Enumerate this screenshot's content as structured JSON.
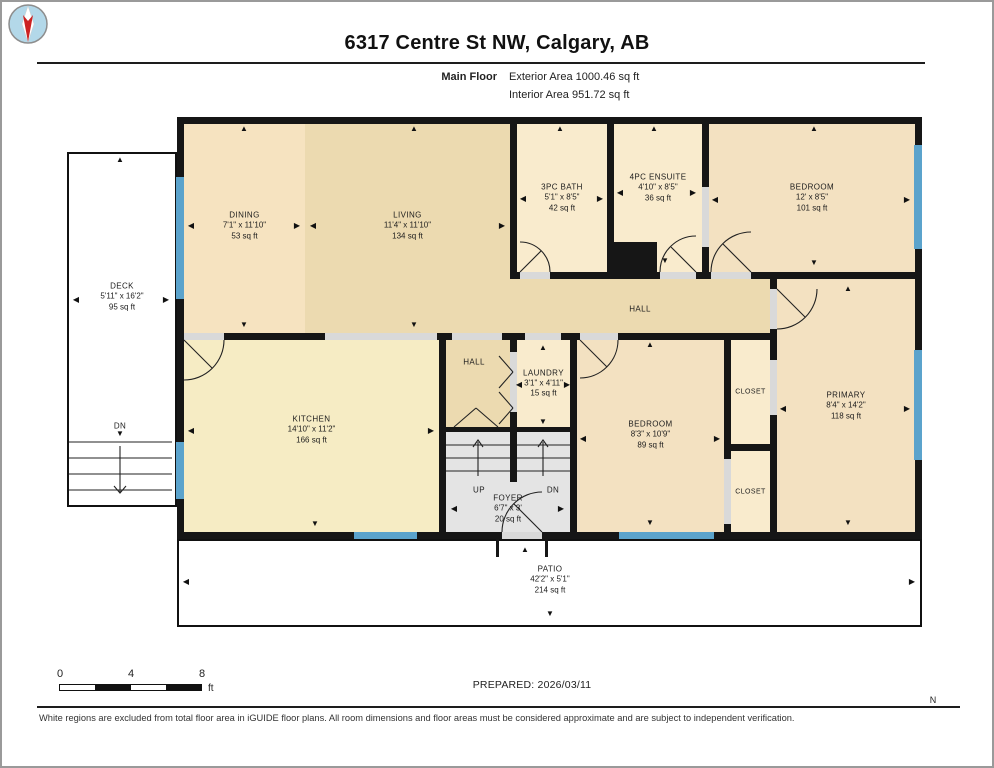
{
  "header": {
    "title": "6317 Centre St NW, Calgary, AB",
    "floor_label": "Main Floor",
    "exterior_area": "Exterior Area 1000.46 sq ft",
    "interior_area": "Interior Area 951.72 sq ft"
  },
  "footer": {
    "scale": {
      "ticks": [
        "0",
        "4",
        "8"
      ],
      "unit": "ft"
    },
    "prepared": "PREPARED: 2026/03/11",
    "compass_label": "N",
    "disclaimer": "White regions are excluded from total floor area in iGUIDE floor plans. All room dimensions and floor areas must be considered approximate and are subject to independent verification."
  },
  "floorplan": {
    "palette": {
      "wall": "#161616",
      "cream": "#f9ebcd",
      "cream2": "#f6e3c0",
      "tan": "#ecdab0",
      "yellow": "#f6ecc4",
      "peach": "#f3e1c1",
      "gray": "#e4e4e4",
      "window": "#5ba3cc",
      "opening": "#d9d9d9",
      "white": "#ffffff"
    },
    "structures": [
      {
        "id": "building-footprint",
        "x": 175,
        "y": 115,
        "w": 745,
        "h": 422,
        "fill": "wall"
      },
      {
        "id": "deck-outline",
        "x": 65,
        "y": 150,
        "w": 110,
        "h": 355,
        "fill": "white",
        "outline": true
      },
      {
        "id": "patio-outline",
        "x": 175,
        "y": 537,
        "w": 745,
        "h": 88,
        "fill": "white",
        "outline": true
      },
      {
        "id": "entry-landing",
        "x": 497,
        "y": 539,
        "w": 46,
        "h": 16,
        "fill": "white"
      }
    ],
    "rooms": [
      {
        "id": "dining",
        "name": "DINING",
        "dims": "7'1\" x 11'10\"",
        "area": "53 sq ft",
        "x": 182,
        "y": 122,
        "w": 121,
        "h": 209,
        "fill": "cream2",
        "ly": 224
      },
      {
        "id": "living",
        "name": "LIVING",
        "dims": "11'4\" x 11'10\"",
        "area": "134 sq ft",
        "x": 303,
        "y": 122,
        "w": 205,
        "h": 209,
        "fill": "tan",
        "ly": 224
      },
      {
        "id": "bath-3pc",
        "name": "3PC BATH",
        "dims": "5'1\" x 8'5\"",
        "area": "42 sq ft",
        "x": 515,
        "y": 122,
        "w": 90,
        "h": 148,
        "fill": "cream"
      },
      {
        "id": "ensuite-4pc",
        "name": "4PC ENSUITE",
        "dims": "4'10\" x 8'5\"",
        "area": "36 sq ft",
        "x": 612,
        "y": 122,
        "w": 88,
        "h": 148,
        "fill": "cream",
        "ly": 186
      },
      {
        "id": "bedroom-top",
        "name": "BEDROOM",
        "dims": "12' x 8'5\"",
        "area": "101 sq ft",
        "x": 707,
        "y": 122,
        "w": 206,
        "h": 148,
        "fill": "peach"
      },
      {
        "id": "hall-main",
        "x": 508,
        "y": 277,
        "w": 260,
        "h": 54,
        "fill": "tan"
      },
      {
        "id": "kitchen",
        "name": "KITCHEN",
        "dims": "14'10\" x 11'2\"",
        "area": "166 sq ft",
        "x": 182,
        "y": 338,
        "w": 255,
        "h": 192,
        "fill": "yellow",
        "ly": 428
      },
      {
        "id": "hall-small",
        "x": 444,
        "y": 338,
        "w": 64,
        "h": 87,
        "fill": "tan"
      },
      {
        "id": "laundry",
        "name": "LAUNDRY",
        "dims": "3'1\" x 4'11\"",
        "area": "15 sq ft",
        "x": 515,
        "y": 338,
        "w": 53,
        "h": 87,
        "fill": "cream"
      },
      {
        "id": "stairs-up",
        "x": 444,
        "y": 430,
        "w": 64,
        "h": 50,
        "fill": "gray"
      },
      {
        "id": "stairs-down",
        "x": 515,
        "y": 430,
        "w": 53,
        "h": 50,
        "fill": "gray"
      },
      {
        "id": "foyer",
        "name": "FOYER",
        "dims": "6'7\" x 3'",
        "area": "20 sq ft",
        "x": 444,
        "y": 480,
        "w": 124,
        "h": 50,
        "fill": "gray",
        "ly": 507
      },
      {
        "id": "bedroom-bottom",
        "name": "BEDROOM",
        "dims": "8'3\" x 10'9\"",
        "area": "89 sq ft",
        "x": 575,
        "y": 338,
        "w": 147,
        "h": 192,
        "fill": "peach",
        "ly": 433
      },
      {
        "id": "closet-top",
        "name": "CLOSET",
        "x": 729,
        "y": 338,
        "w": 39,
        "h": 104,
        "fill": "cream",
        "fs": 7
      },
      {
        "id": "closet-bottom",
        "name": "CLOSET",
        "x": 729,
        "y": 449,
        "w": 39,
        "h": 81,
        "fill": "cream",
        "fs": 7
      },
      {
        "id": "primary",
        "name": "PRIMARY",
        "dims": "8'4\" x 14'2\"",
        "area": "118 sq ft",
        "x": 775,
        "y": 277,
        "w": 138,
        "h": 253,
        "fill": "peach",
        "ly": 404
      },
      {
        "id": "deck",
        "name": "DECK",
        "dims": "5'11\" x 16'2\"",
        "area": "95 sq ft",
        "lx": 120,
        "ly": 295
      },
      {
        "id": "patio",
        "name": "PATIO",
        "dims": "42'2\" x 5'1\"",
        "area": "214 sq ft",
        "lx": 548,
        "ly": 578
      }
    ],
    "labels": [
      {
        "t": "HALL",
        "x": 638,
        "y": 307
      },
      {
        "t": "HALL",
        "x": 472,
        "y": 360
      },
      {
        "t": "UP",
        "x": 477,
        "y": 488
      },
      {
        "t": "DN",
        "x": 551,
        "y": 488
      },
      {
        "t": "DN",
        "x": 118,
        "y": 424
      }
    ],
    "openings": [
      {
        "x": 518,
        "y": 270,
        "w": 30,
        "h": 7
      },
      {
        "x": 658,
        "y": 270,
        "w": 36,
        "h": 7
      },
      {
        "x": 709,
        "y": 270,
        "w": 40,
        "h": 7
      },
      {
        "x": 700,
        "y": 185,
        "w": 7,
        "h": 60
      },
      {
        "x": 768,
        "y": 287,
        "w": 7,
        "h": 40
      },
      {
        "x": 182,
        "y": 331,
        "w": 40,
        "h": 7
      },
      {
        "x": 323,
        "y": 331,
        "w": 112,
        "h": 7
      },
      {
        "x": 450,
        "y": 331,
        "w": 50,
        "h": 7
      },
      {
        "x": 523,
        "y": 331,
        "w": 36,
        "h": 7
      },
      {
        "x": 578,
        "y": 331,
        "w": 38,
        "h": 7
      },
      {
        "x": 500,
        "y": 530,
        "w": 40,
        "h": 7
      },
      {
        "x": 768,
        "y": 358,
        "w": 7,
        "h": 55
      },
      {
        "x": 722,
        "y": 457,
        "w": 7,
        "h": 65
      },
      {
        "x": 508,
        "y": 350,
        "w": 7,
        "h": 60
      }
    ],
    "windows": [
      {
        "x": 174,
        "y": 175,
        "w": 8,
        "h": 122
      },
      {
        "x": 174,
        "y": 440,
        "w": 8,
        "h": 57
      },
      {
        "x": 352,
        "y": 530,
        "w": 63,
        "h": 7
      },
      {
        "x": 617,
        "y": 530,
        "w": 95,
        "h": 7
      },
      {
        "x": 912,
        "y": 143,
        "w": 8,
        "h": 104
      },
      {
        "x": 912,
        "y": 348,
        "w": 8,
        "h": 110
      }
    ],
    "patches": [
      {
        "x": 612,
        "y": 240,
        "w": 43,
        "h": 30
      },
      {
        "x": 494,
        "y": 537,
        "w": 3,
        "h": 18
      },
      {
        "x": 543,
        "y": 537,
        "w": 3,
        "h": 18
      }
    ],
    "paths": [
      "M 67 440 H 170",
      "M 67 456 H 170",
      "M 67 472 H 170",
      "M 67 488 H 170",
      "M 118 444 V 490",
      "M 112 484 L 118 491 L 124 484",
      "M 444 443 H 508",
      "M 444 456 H 508",
      "M 444 469 H 508",
      "M 515 443 H 568",
      "M 515 456 H 568",
      "M 515 469 H 568",
      "M 476 474 V 440",
      "M 471 445 L 476 438 L 481 445",
      "M 541 474 V 440",
      "M 536 445 L 541 438 L 546 445",
      "M 548 270 A 30 30 0 0 0 518 240",
      "M 518 270 L 539 249",
      "M 658 270 A 36 36 0 0 1 694 234",
      "M 694 270 L 669 245",
      "M 709 270 A 40 40 0 0 1 749 230",
      "M 749 270 L 721 242",
      "M 775 327 A 40 40 0 0 0 815 287",
      "M 775 287 L 803 315",
      "M 222 338 A 40 40 0 0 1 182 378",
      "M 182 338 L 210 366",
      "M 616 338 A 38 38 0 0 1 578 376",
      "M 578 338 L 605 365",
      "M 500 530 A 40 40 0 0 1 540 490",
      "M 540 530 L 512 502",
      "M 452 425 L 474 406",
      "M 496 425 L 474 406",
      "M 497 354 L 511 370",
      "M 497 386 L 511 370",
      "M 497 390 L 511 406",
      "M 497 422 L 511 406"
    ],
    "arrows": [
      {
        "x": 242,
        "y": 127,
        "d": "u"
      },
      {
        "x": 242,
        "y": 323,
        "d": "d"
      },
      {
        "x": 189,
        "y": 224,
        "d": "l"
      },
      {
        "x": 295,
        "y": 224,
        "d": "r"
      },
      {
        "x": 311,
        "y": 224,
        "d": "l"
      },
      {
        "x": 412,
        "y": 127,
        "d": "u"
      },
      {
        "x": 412,
        "y": 323,
        "d": "d"
      },
      {
        "x": 500,
        "y": 224,
        "d": "r"
      },
      {
        "x": 558,
        "y": 127,
        "d": "u"
      },
      {
        "x": 521,
        "y": 197,
        "d": "l"
      },
      {
        "x": 598,
        "y": 197,
        "d": "r"
      },
      {
        "x": 652,
        "y": 127,
        "d": "u"
      },
      {
        "x": 618,
        "y": 191,
        "d": "l"
      },
      {
        "x": 691,
        "y": 191,
        "d": "r"
      },
      {
        "x": 663,
        "y": 259,
        "d": "d"
      },
      {
        "x": 812,
        "y": 127,
        "d": "u"
      },
      {
        "x": 812,
        "y": 261,
        "d": "d"
      },
      {
        "x": 713,
        "y": 198,
        "d": "l"
      },
      {
        "x": 905,
        "y": 198,
        "d": "r"
      },
      {
        "x": 846,
        "y": 287,
        "d": "u"
      },
      {
        "x": 846,
        "y": 521,
        "d": "d"
      },
      {
        "x": 781,
        "y": 407,
        "d": "l"
      },
      {
        "x": 905,
        "y": 407,
        "d": "r"
      },
      {
        "x": 189,
        "y": 429,
        "d": "l"
      },
      {
        "x": 429,
        "y": 429,
        "d": "r"
      },
      {
        "x": 313,
        "y": 522,
        "d": "d"
      },
      {
        "x": 648,
        "y": 343,
        "d": "u"
      },
      {
        "x": 648,
        "y": 521,
        "d": "d"
      },
      {
        "x": 581,
        "y": 437,
        "d": "l"
      },
      {
        "x": 715,
        "y": 437,
        "d": "r"
      },
      {
        "x": 541,
        "y": 346,
        "d": "u"
      },
      {
        "x": 541,
        "y": 420,
        "d": "d"
      },
      {
        "x": 517,
        "y": 383,
        "d": "l"
      },
      {
        "x": 565,
        "y": 383,
        "d": "r"
      },
      {
        "x": 452,
        "y": 507,
        "d": "l"
      },
      {
        "x": 559,
        "y": 507,
        "d": "r"
      },
      {
        "x": 118,
        "y": 158,
        "d": "u"
      },
      {
        "x": 74,
        "y": 298,
        "d": "l"
      },
      {
        "x": 164,
        "y": 298,
        "d": "r"
      },
      {
        "x": 118,
        "y": 432,
        "d": "d"
      },
      {
        "x": 184,
        "y": 580,
        "d": "l"
      },
      {
        "x": 910,
        "y": 580,
        "d": "r"
      },
      {
        "x": 548,
        "y": 612,
        "d": "d"
      },
      {
        "x": 523,
        "y": 548,
        "d": "u"
      }
    ]
  }
}
